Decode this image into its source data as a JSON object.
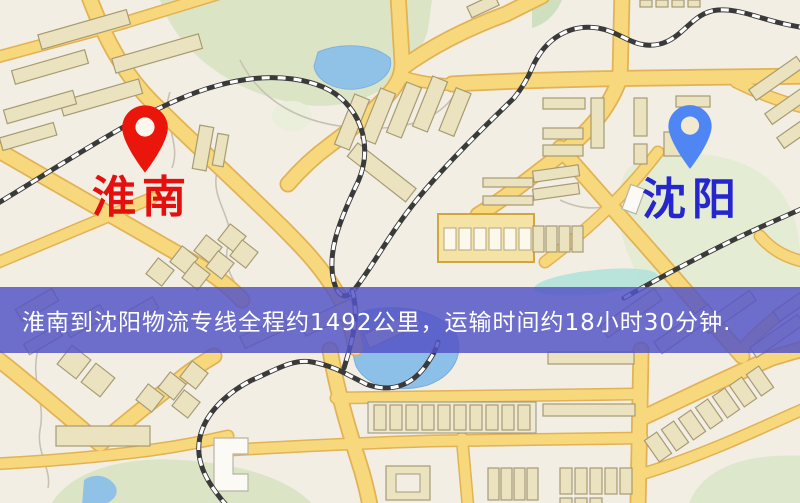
{
  "map": {
    "origin": {
      "label": "淮南",
      "pin_color": "#ea150b",
      "label_color": "#e60f0f"
    },
    "destination": {
      "label": "沈阳",
      "pin_color": "#4f86f3",
      "label_color": "#2626cf"
    },
    "banner": {
      "text": "淮南到沈阳物流专线全程约1492公里，运输时间约18小时30分钟.",
      "background_color": "#5454c6",
      "text_color": "#ffffff"
    },
    "route": {
      "distance_km": 1492,
      "duration": "18小时30分钟"
    },
    "palette": {
      "map_background": "#f2eee4",
      "road_fill": "#f7d87c",
      "road_casing": "#e2b254",
      "park_green": "#dbe5c6",
      "water_blue": "#90c2e8",
      "stream_teal": "#b2e2da",
      "building_fill": "#ebe2c0",
      "railway_dark": "#3a3a3a"
    }
  }
}
